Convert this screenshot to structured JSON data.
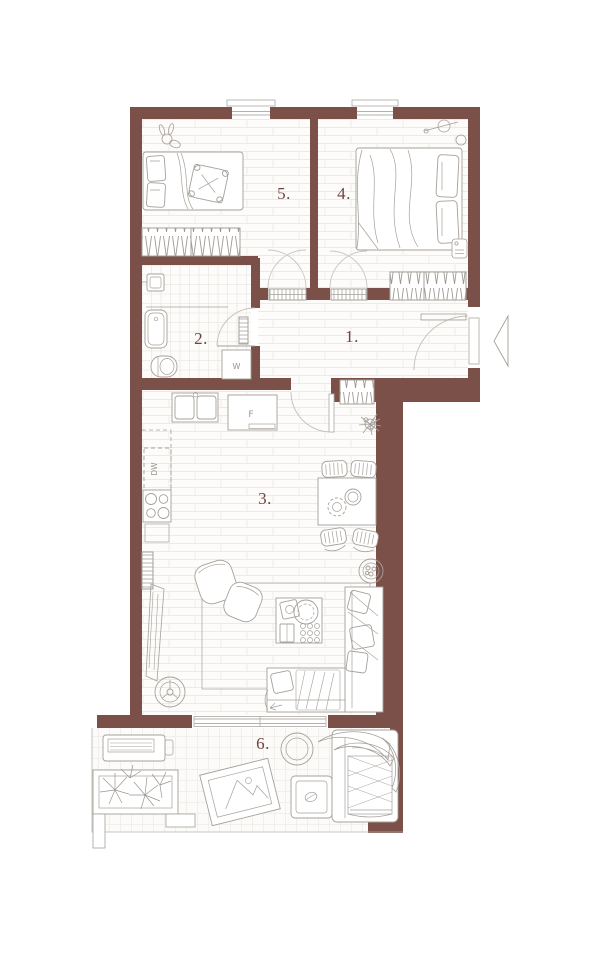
{
  "plan": {
    "type": "apartment-floor-plan",
    "room_labels": {
      "room1": "1.",
      "room2": "2.",
      "room3": "3.",
      "room4": "4.",
      "room5": "5.",
      "room6": "6."
    },
    "appliance_labels": {
      "fridge": "F",
      "washing_machine": "W",
      "dishwasher": "DW"
    },
    "colors": {
      "wall": "#7b5048",
      "room_label": "#6d453f",
      "furniture_outline": "#a5a09a",
      "floor": "#fdfcfa"
    }
  }
}
